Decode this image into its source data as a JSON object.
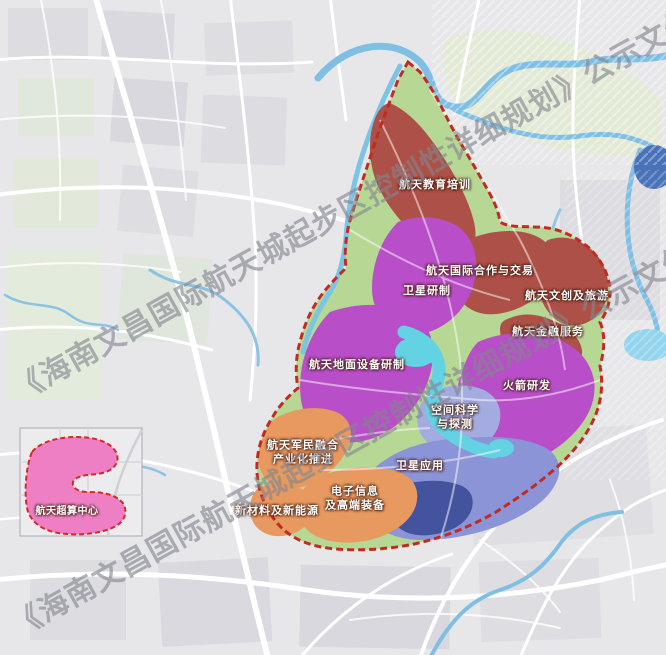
{
  "watermark": {
    "text": "《海南文昌国际航天城起步区控制性详细规划》公示文件"
  },
  "zones": [
    {
      "id": "edu",
      "label": "航天教育培训"
    },
    {
      "id": "coop",
      "label": "航天国际合作与交易"
    },
    {
      "id": "satdev",
      "label": "卫星研制"
    },
    {
      "id": "cultural",
      "label": "航天文创及旅游"
    },
    {
      "id": "finance",
      "label": "航天金融服务"
    },
    {
      "id": "ground",
      "label": "航天地面设备研制"
    },
    {
      "id": "rocket",
      "label": "火箭研发"
    },
    {
      "id": "spacesci",
      "label": "空间科学\n与探测"
    },
    {
      "id": "satapp",
      "label": "卫星应用"
    },
    {
      "id": "military",
      "label": "航天军民融合\n产业化推进"
    },
    {
      "id": "electronics",
      "label": "电子信息\n及高端装备"
    },
    {
      "id": "materials",
      "label": "新材料及新能源"
    },
    {
      "id": "supercomputing",
      "label": "航天超算中心"
    }
  ],
  "colors": {
    "brick": "#ad5047",
    "magenta": "#b84ec8",
    "orange": "#e8995f",
    "periwinkle": "#8a94d6",
    "navy": "#44539e",
    "lavender": "#a3abe0",
    "cyan": "#63d2e2",
    "green_base": "#b7d795",
    "pink": "#ee7fc4",
    "boundary_red": "#c42a20",
    "river_blue": "#7fbfe4",
    "bay_blue": "#4a72b8"
  }
}
